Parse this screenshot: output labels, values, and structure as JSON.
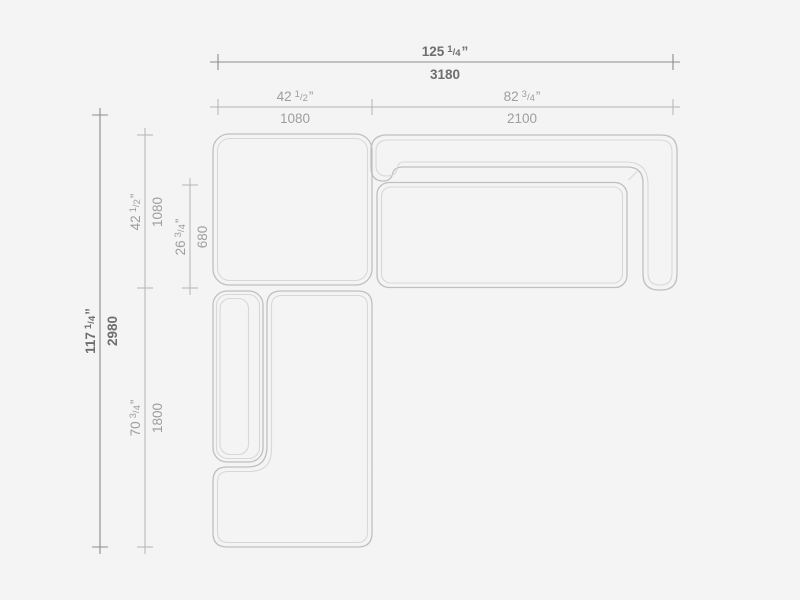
{
  "theme": {
    "background": "#f4f4f4",
    "module_outer": "#bfbfbf",
    "module_inner": "#d8d8d8",
    "dim_primary_line": "#8c8c8c",
    "dim_secondary_line": "#b5b5b5",
    "dim_primary_text": "#6e6e6e",
    "dim_secondary_text": "#9e9e9e"
  },
  "dims": {
    "overall_width": {
      "whole": "125",
      "num": "1",
      "sep": "/",
      "den": "4",
      "unit": "”",
      "mm": "3180"
    },
    "corner_width": {
      "whole": "42",
      "num": "1",
      "sep": "/",
      "den": "2",
      "unit": "”",
      "mm": "1080"
    },
    "sofa_width": {
      "whole": "82",
      "num": "3",
      "sep": "/",
      "den": "4",
      "unit": "”",
      "mm": "2100"
    },
    "overall_depth": {
      "whole": "117",
      "num": "1",
      "sep": "/",
      "den": "4",
      "unit": "”",
      "mm": "2980"
    },
    "corner_depth": {
      "whole": "42",
      "num": "1",
      "sep": "/",
      "den": "2",
      "unit": "”",
      "mm": "1080"
    },
    "seat_depth": {
      "whole": "26",
      "num": "3",
      "sep": "/",
      "den": "4",
      "unit": "”",
      "mm": "680"
    },
    "chaise_length": {
      "whole": "70",
      "num": "3",
      "sep": "/",
      "den": "4",
      "unit": "”",
      "mm": "1800"
    }
  }
}
